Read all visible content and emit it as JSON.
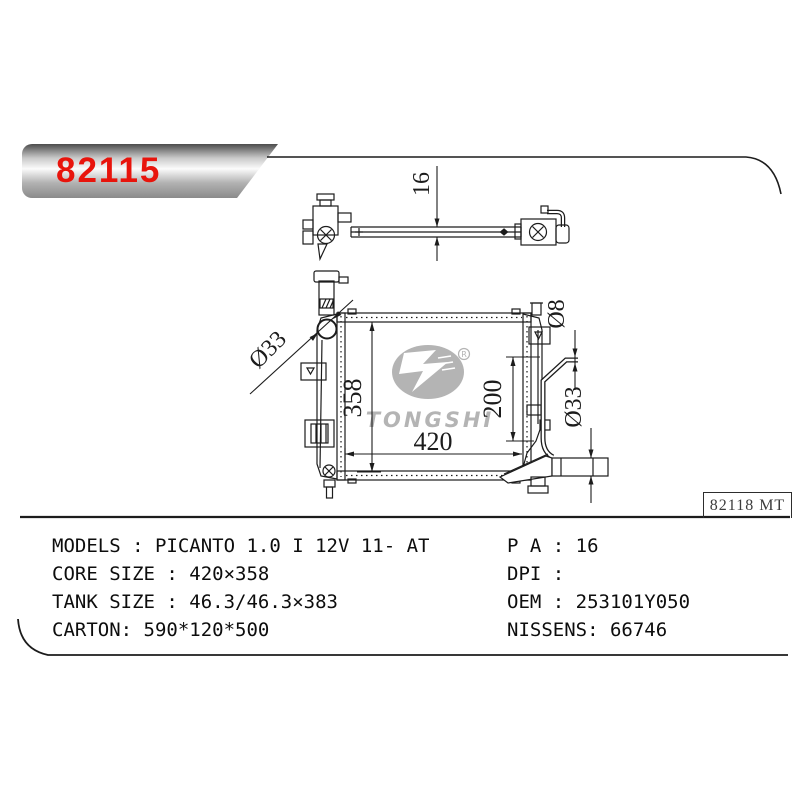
{
  "banner": {
    "part_number": "82115"
  },
  "watermark": {
    "brand": "TONGSHI",
    "registered_mark": "R"
  },
  "drawing": {
    "code_box": {
      "text": "82118 MT"
    },
    "dims": {
      "thickness": "16",
      "filler_diameter": "Ø33",
      "core_height": "358",
      "core_width": "420",
      "outlet_offset": "200",
      "overflow_tube_diameter": "Ø8",
      "outlet_diameter": "Ø33"
    }
  },
  "specs": {
    "left": [
      "MODELS : PICANTO 1.0 I 12V 11- AT",
      "CORE SIZE : 420×358",
      "TANK SIZE : 46.3/46.3×383",
      "CARTON: 590*120*500"
    ],
    "right": [
      "P A : 16",
      "DPI :",
      "OEM : 253101Y050",
      "NISSENS: 66746"
    ]
  },
  "colors": {
    "accent_red": "#e8140c",
    "line": "#1c1c1c",
    "watermark_gray": "#b4b4b4"
  }
}
